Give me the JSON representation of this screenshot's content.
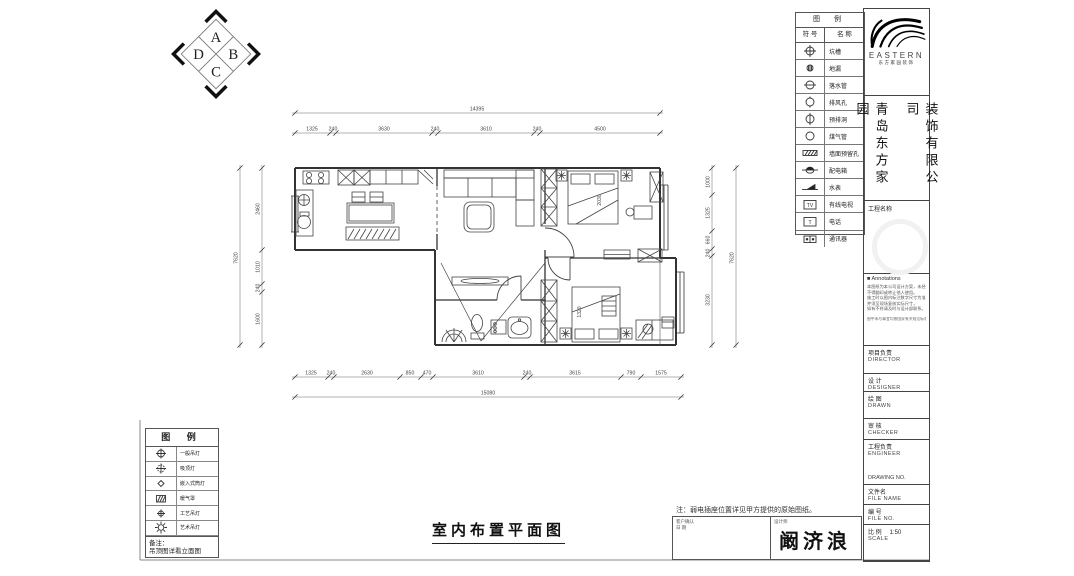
{
  "sheet": {
    "bg": "#ffffff",
    "line": "#3a3a3a",
    "dim_color": "#555555"
  },
  "logo_adcb": {
    "top": "A",
    "left": "D",
    "right": "B",
    "bottom": "C"
  },
  "legend_right": {
    "title": "图 例",
    "col_symbol": "符 号",
    "col_name": "名 称",
    "rows": [
      {
        "icon": "pit",
        "label": "坑槽"
      },
      {
        "icon": "drain",
        "label": "地漏"
      },
      {
        "icon": "downpipe",
        "label": "落水管"
      },
      {
        "icon": "vent",
        "label": "排风孔"
      },
      {
        "icon": "hole",
        "label": "预排洞"
      },
      {
        "icon": "gas",
        "label": "煤气管"
      },
      {
        "icon": "wallhole",
        "label": "墙面预留孔"
      },
      {
        "icon": "power",
        "label": "配电箱"
      },
      {
        "icon": "meter",
        "label": "水表"
      },
      {
        "icon": "tv",
        "label": "有线电视"
      },
      {
        "icon": "phone",
        "label": "电话"
      },
      {
        "icon": "comm",
        "label": "通讯器"
      }
    ]
  },
  "brand": {
    "name": "EASTERN",
    "subtitle": "东方家园装饰",
    "company_col_left": "青岛东方家园",
    "company_col_right": "装饰有限公司",
    "project_label": "工程名称"
  },
  "titleblock": {
    "annotations_title": "■ Annotations",
    "annotation_lines": [
      "本图纸为本公司设计方案，未经许可",
      "不得翻印或转让他人使用。",
      "施工时以图内标注数字尺寸为准，",
      "并须至现场复核实际尺寸，",
      "如有不符请及时与设计部联系。"
    ],
    "annotation_footer": "图中未尽事宜均按国家有关规范标准执行",
    "fields": [
      {
        "cn": "项目负责",
        "en": "DIRECTOR"
      },
      {
        "cn": "设 计",
        "en": "DESIGNER"
      },
      {
        "cn": "绘 图",
        "en": "DRAWN"
      },
      {
        "cn": "审 核",
        "en": "CHECKER"
      },
      {
        "cn": "工程负责",
        "en": "ENGINEER",
        "extra": "DRAWING NO."
      },
      {
        "cn": "文件名",
        "en": "FILE NAME"
      },
      {
        "cn": "编  号",
        "en": "FILE NO."
      },
      {
        "cn": "比  例",
        "en": "SCALE",
        "value": "1:50"
      }
    ]
  },
  "legend_left": {
    "title": "图 例",
    "rows": [
      {
        "icon": "lamp",
        "label": "一般吊灯"
      },
      {
        "icon": "ceil",
        "label": "吸顶灯"
      },
      {
        "icon": "spot",
        "label": "嵌入式筒灯"
      },
      {
        "icon": "heater",
        "label": "暖气罩"
      },
      {
        "icon": "craft",
        "label": "工艺吊灯"
      },
      {
        "icon": "art",
        "label": "艺术吊灯"
      }
    ],
    "note_label": "备注：",
    "note": "吊顶图详看立面图"
  },
  "plan": {
    "title": "室内布置平面图",
    "note": "注：弱电插座位置详见甲方提供的原始图纸。",
    "signature": "阚济浪",
    "sig_left_lines": [
      "客户确认",
      "日  期"
    ],
    "sig_right_label": "设计师",
    "dimensions": [
      {
        "o": "h",
        "line": 113,
        "a": 295,
        "b": 660,
        "ticks": [
          295,
          660
        ],
        "labels": [
          {
            "p": 477,
            "t": "14395"
          }
        ]
      },
      {
        "o": "h",
        "line": 133,
        "a": 295,
        "b": 660,
        "ticks": [
          295,
          330,
          336,
          432,
          438,
          534,
          540,
          660
        ],
        "labels": [
          {
            "p": 312,
            "t": "1325"
          },
          {
            "p": 333,
            "t": "240"
          },
          {
            "p": 384,
            "t": "3630"
          },
          {
            "p": 435,
            "t": "240"
          },
          {
            "p": 486,
            "t": "3610"
          },
          {
            "p": 537,
            "t": "240"
          },
          {
            "p": 600,
            "t": "4500"
          }
        ]
      },
      {
        "o": "h",
        "line": 377,
        "a": 295,
        "b": 681,
        "ticks": [
          295,
          328,
          334,
          400,
          421,
          433,
          524,
          530,
          621,
          641,
          681
        ],
        "labels": [
          {
            "p": 311,
            "t": "1325"
          },
          {
            "p": 331,
            "t": "240"
          },
          {
            "p": 367,
            "t": "2630"
          },
          {
            "p": 410,
            "t": "850"
          },
          {
            "p": 427,
            "t": "470"
          },
          {
            "p": 478,
            "t": "3610"
          },
          {
            "p": 527,
            "t": "240"
          },
          {
            "p": 575,
            "t": "3615"
          },
          {
            "p": 631,
            "t": "790"
          },
          {
            "p": 661,
            "t": "1575"
          }
        ]
      },
      {
        "o": "h",
        "line": 397,
        "a": 295,
        "b": 681,
        "ticks": [
          295,
          681
        ],
        "labels": [
          {
            "p": 488,
            "t": "15080"
          }
        ]
      },
      {
        "o": "v",
        "line": 240,
        "a": 168,
        "b": 345,
        "ticks": [
          168,
          345
        ],
        "labels": [
          {
            "p": 258,
            "t": "7620"
          }
        ]
      },
      {
        "o": "v",
        "line": 262,
        "a": 168,
        "b": 345,
        "ticks": [
          168,
          250,
          284,
          292,
          345
        ],
        "labels": [
          {
            "p": 209,
            "t": "2460"
          },
          {
            "p": 267,
            "t": "1010"
          },
          {
            "p": 288,
            "t": "240"
          },
          {
            "p": 319,
            "t": "1600"
          }
        ]
      },
      {
        "o": "v",
        "line": 712,
        "a": 168,
        "b": 345,
        "ticks": [
          168,
          195,
          231,
          249,
          256,
          345
        ],
        "labels": [
          {
            "p": 182,
            "t": "1000"
          },
          {
            "p": 213,
            "t": "1325"
          },
          {
            "p": 240,
            "t": "660"
          },
          {
            "p": 253,
            "t": "240"
          },
          {
            "p": 300,
            "t": "3230"
          }
        ]
      },
      {
        "o": "v",
        "line": 736,
        "a": 168,
        "b": 345,
        "ticks": [
          168,
          345
        ],
        "labels": [
          {
            "p": 258,
            "t": "7620"
          }
        ]
      }
    ],
    "inline_labels": [
      {
        "x": 601,
        "y": 200,
        "t": "2030",
        "rot": -90
      },
      {
        "x": 581,
        "y": 312,
        "t": "1320",
        "rot": -90
      }
    ]
  }
}
